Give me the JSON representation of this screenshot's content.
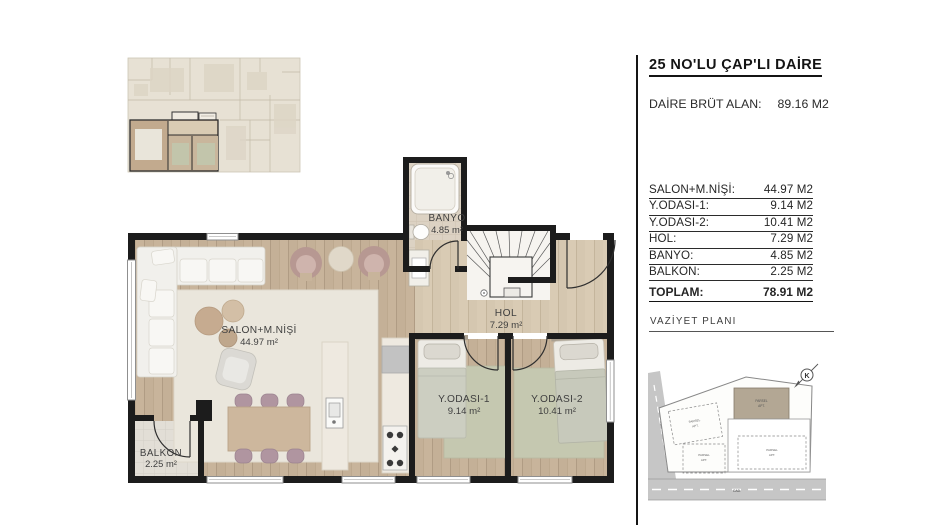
{
  "panel": {
    "title": "25 NO'LU ÇAP'LI DAİRE",
    "gross_label": "DAİRE BRÜT ALAN:",
    "gross_value": "89.16 M2",
    "rows": [
      {
        "label": "SALON+M.NİŞİ:",
        "value": "44.97 M2"
      },
      {
        "label": "Y.ODASI-1:",
        "value": "9.14 M2"
      },
      {
        "label": "Y.ODASI-2:",
        "value": "10.41 M2"
      },
      {
        "label": "HOL:",
        "value": "7.29 M2"
      },
      {
        "label": "BANYO:",
        "value": "4.85 M2"
      },
      {
        "label": "BALKON:",
        "value": "2.25 M2"
      }
    ],
    "total": {
      "label": "TOPLAM:",
      "value": "78.91 M2"
    },
    "site_plan_title": "VAZİYET PLANI"
  },
  "plan": {
    "salon": {
      "name": "SALON+M.NİŞİ",
      "area": "44.97 m²"
    },
    "banyo": {
      "name": "BANYO",
      "area": "4.85 m²"
    },
    "hol": {
      "name": "HOL",
      "area": "7.29 m²"
    },
    "bedroom1": {
      "name": "Y.ODASI-1",
      "area": "9.14 m²"
    },
    "bedroom2": {
      "name": "Y.ODASI-2",
      "area": "10.41 m²"
    },
    "balkon": {
      "name": "BALKON",
      "area": "2.25 m²"
    }
  },
  "site_plan": {
    "north_label": "K",
    "road_label": "CAD.",
    "side_road_label": "SOKAK",
    "parcels": [
      {
        "line1": "PARSEL",
        "line2": "APT."
      },
      {
        "line1": "PARSEL",
        "line2": "APT."
      },
      {
        "line1": "PARSEL",
        "line2": "APT."
      },
      {
        "line1": "PARSEL",
        "line2": "APT."
      }
    ]
  },
  "colors": {
    "wall": "#1c1c1c",
    "wood_floor": "#c8b49b",
    "hol_floor": "#d9cbb4",
    "tile_floor": "#dcd2c3",
    "balcony_floor": "#e2ded6",
    "rug": "#eae6dc",
    "bedroom_rug": "#c5c8b0",
    "accent_mauve": "#b79892",
    "site_building": "#b3a794",
    "road": "#c6c6c6"
  }
}
